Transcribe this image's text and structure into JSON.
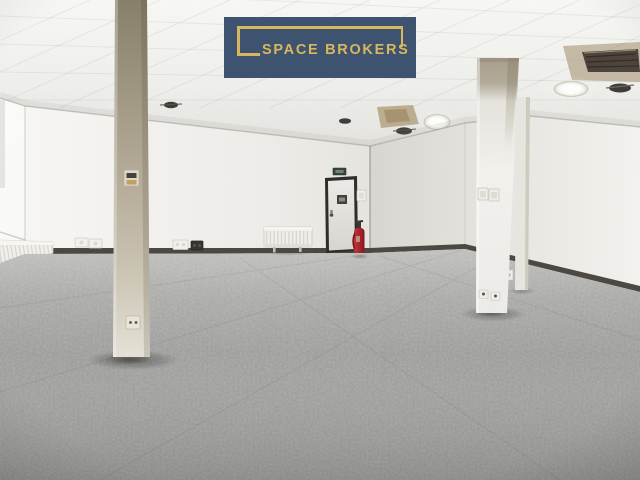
{
  "logo": {
    "text": "SPACE BROKERS",
    "background_color": "#3d536f",
    "accent_color": "#d9b760"
  },
  "scene": {
    "kind": "interior-photograph",
    "description": "Empty open-plan office: grey mottled carpet tiles, white walls, suspended tile ceiling with round recessed lights, two support columns, rear door with fire extinguisher, radiators, wall sockets and switches",
    "colors": {
      "carpet": "#9a9b99",
      "wall": "#f0efeb",
      "ceiling": "#f2f2ef",
      "left_column": "#a89f8b",
      "right_column": "#f2f1ed",
      "door_frame": "#2b2a27",
      "door_panel": "#e9e7e2",
      "fire_extinguisher": "#b2252c",
      "baseboard": "#4a463f",
      "ceiling_stain": "#a8936a"
    },
    "objects": [
      "ceiling-light",
      "smoke-detector",
      "air-vent",
      "stained-ceiling-tile",
      "door",
      "emergency-exit-sign",
      "door-sign",
      "door-handle",
      "light-switch",
      "fire-extinguisher",
      "radiator",
      "power-outlet",
      "support-column",
      "thermostat",
      "carpet-floor",
      "window-wall"
    ]
  }
}
